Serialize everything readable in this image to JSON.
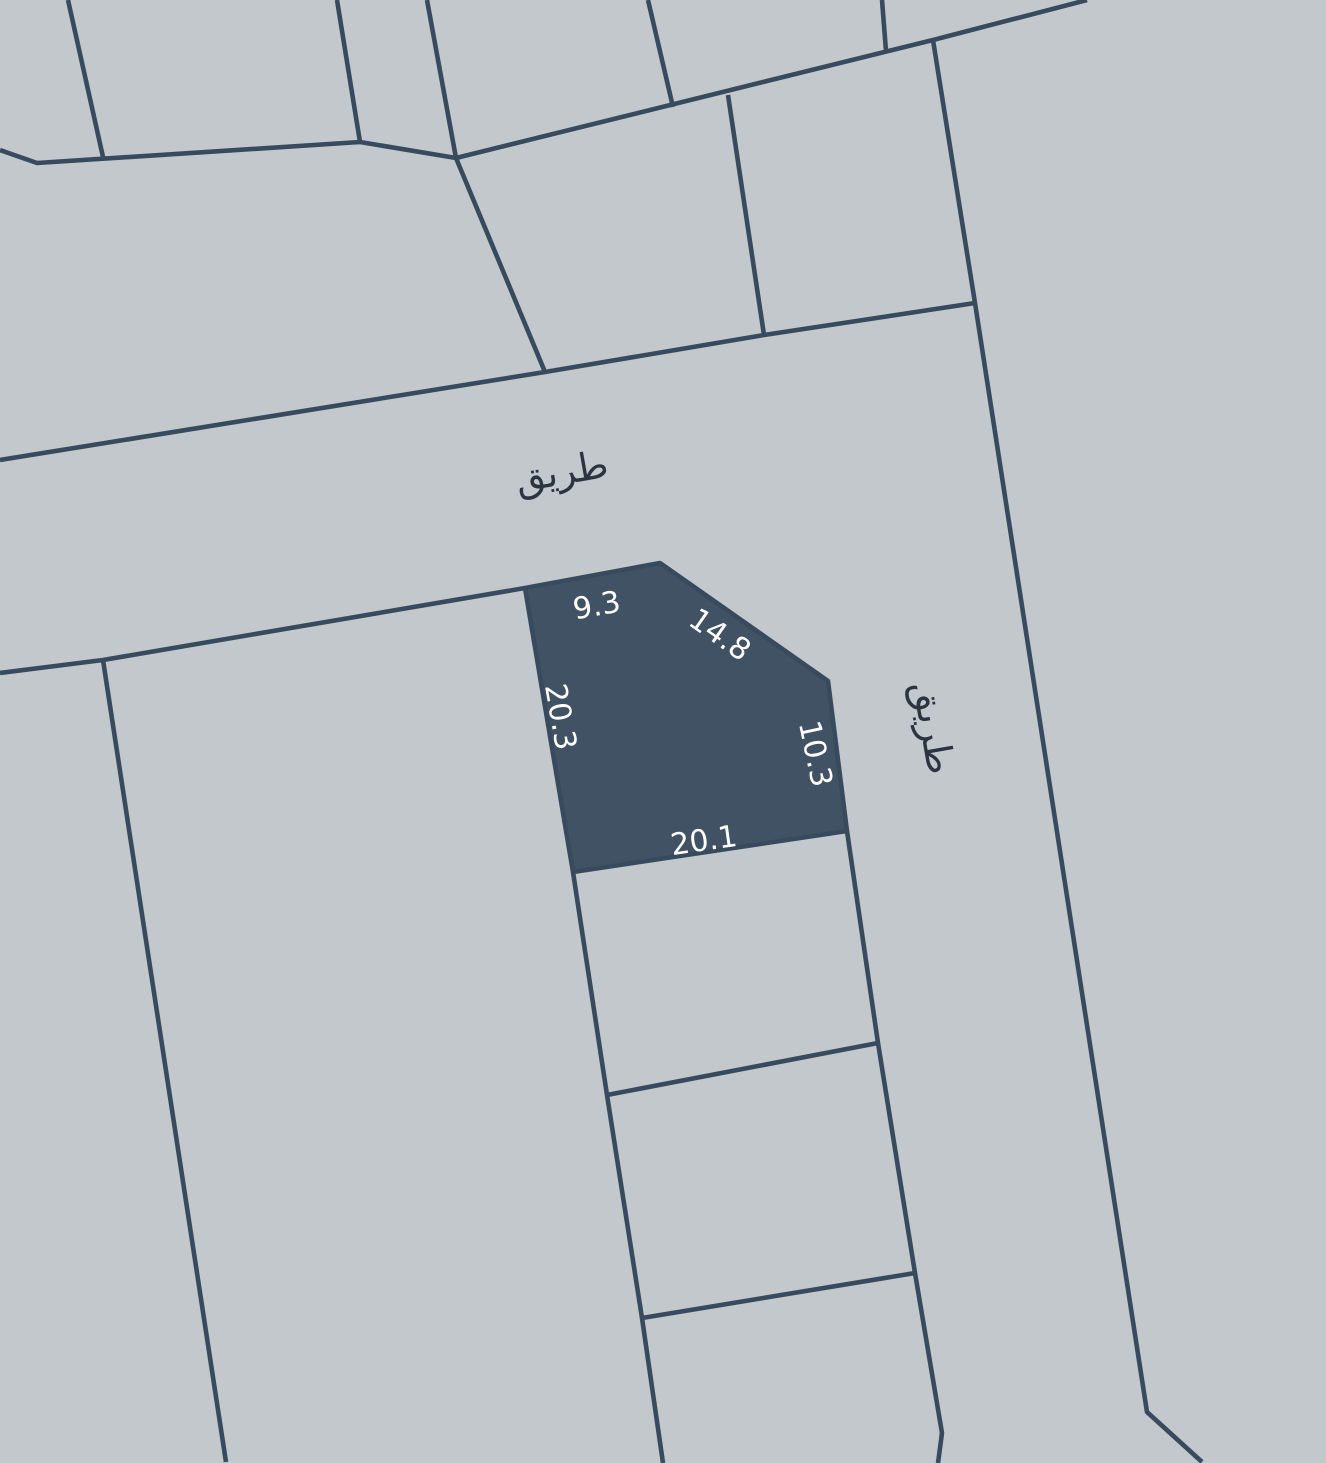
{
  "map": {
    "colors": {
      "background": "#c3c8cc",
      "boundary_line": "#384b5e",
      "highlighted_parcel_fill": "#415264",
      "road_label_color": "#2b3440",
      "dimension_label_color": "#ffffff"
    },
    "road_labels": [
      {
        "name": "horizontal-road",
        "text": "طريق"
      },
      {
        "name": "vertical-road",
        "text": "طريق"
      }
    ],
    "highlighted_parcel": {
      "dimension_labels": [
        {
          "edge": "north",
          "text": "9.3"
        },
        {
          "edge": "northeast-chamfer",
          "text": "14.8"
        },
        {
          "edge": "west",
          "text": "20.3"
        },
        {
          "edge": "east",
          "text": "10.3"
        },
        {
          "edge": "south",
          "text": "20.1"
        }
      ]
    }
  }
}
